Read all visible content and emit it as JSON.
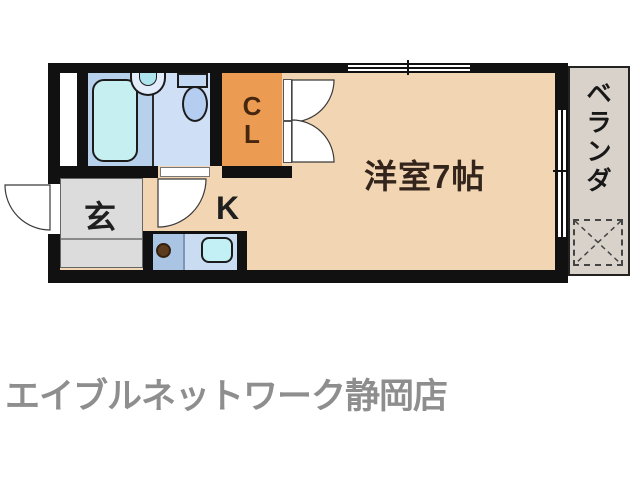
{
  "floor_plan": {
    "labels": {
      "closet_line1": "C",
      "closet_line2": "L",
      "entrance": "玄",
      "kitchen": "K",
      "main_room": "洋室7帖",
      "veranda_chars": [
        "ベ",
        "ラ",
        "ン",
        "ダ"
      ]
    },
    "colors": {
      "wall": "#111111",
      "floor": "#f2d5b2",
      "closet_orange": "#eb9b52",
      "bath_left": "#b7d0ec",
      "bath_right": "#cfdff6",
      "bathtub": "#c6eff2",
      "entrance_gray": "#dcdcdc",
      "counter_stove": "#aac4e4",
      "counter_sink": "#c9dcf2",
      "veranda_gray": "#d8d2ca",
      "footer_gray": "#8e8e8e"
    }
  },
  "footer": {
    "store_name": "エイブルネットワーク静岡店"
  }
}
